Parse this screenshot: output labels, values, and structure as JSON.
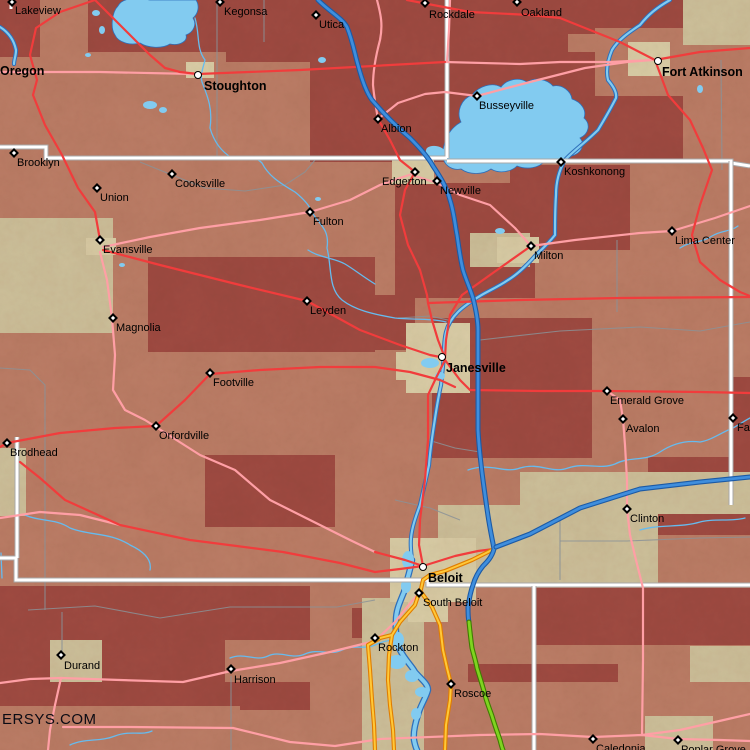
{
  "map": {
    "width": 750,
    "height": 750,
    "region": "southern-wisconsin-northern-illinois"
  },
  "watermark": {
    "text": "ERSYS.COM"
  },
  "colors": {
    "terrain_salmon": "#bd7e67",
    "terrain_maroon": "#a04b42",
    "terrain_tan": "#cfc29c",
    "terrain_urban": "#dbcfa8",
    "lake_fill": "#82cbf0",
    "water_casing": "#2e6fba",
    "creek": "#66bbee",
    "boundary_gray": "#8b9297",
    "road_white": "#ffffff",
    "road_white_casing": "#a8a8a8",
    "road_red": "#f13c3c",
    "road_pink": "#ff9fa5",
    "orange_core": "#ffc838",
    "orange_casing": "#e07d00",
    "interstate_core": "#3f8edd",
    "interstate_casing": "#1c5aa5",
    "toll_green_core": "#7fd420",
    "toll_green_casing": "#3f7d00",
    "label_color": "#000000"
  },
  "towns": [
    {
      "name": "Lakeview",
      "type": "town",
      "mx": 12,
      "my": 2,
      "lx": 15,
      "ly": 6
    },
    {
      "name": "Kegonsa",
      "type": "town",
      "mx": 220,
      "my": 2,
      "lx": 224,
      "ly": 7
    },
    {
      "name": "Utica",
      "type": "town",
      "mx": 316,
      "my": 15,
      "lx": 319,
      "ly": 20
    },
    {
      "name": "Rockdale",
      "type": "town",
      "mx": 425,
      "my": 3,
      "lx": 429,
      "ly": 10
    },
    {
      "name": "Oakland",
      "type": "town",
      "mx": 517,
      "my": 2,
      "lx": 521,
      "ly": 8
    },
    {
      "name": "Oregon",
      "type": "city",
      "mx": -6,
      "my": 72,
      "lx": 0,
      "ly": 65
    },
    {
      "name": "Stoughton",
      "type": "city",
      "mx": 198,
      "my": 75,
      "lx": 204,
      "ly": 80
    },
    {
      "name": "Fort Atkinson",
      "type": "city",
      "mx": 658,
      "my": 61,
      "lx": 662,
      "ly": 66
    },
    {
      "name": "Busseyville",
      "type": "town",
      "mx": 477,
      "my": 96,
      "lx": 479,
      "ly": 101
    },
    {
      "name": "Albion",
      "type": "town",
      "mx": 378,
      "my": 119,
      "lx": 381,
      "ly": 124
    },
    {
      "name": "Brooklyn",
      "type": "town",
      "mx": 14,
      "my": 153,
      "lx": 17,
      "ly": 158
    },
    {
      "name": "Cooksville",
      "type": "town",
      "mx": 172,
      "my": 174,
      "lx": 175,
      "ly": 179
    },
    {
      "name": "Union",
      "type": "town",
      "mx": 97,
      "my": 188,
      "lx": 100,
      "ly": 193
    },
    {
      "name": "Fulton",
      "type": "town",
      "mx": 310,
      "my": 212,
      "lx": 313,
      "ly": 217
    },
    {
      "name": "Edgerton",
      "type": "town",
      "mx": 415,
      "my": 172,
      "lx": 382,
      "ly": 177
    },
    {
      "name": "Newville",
      "type": "town",
      "mx": 437,
      "my": 181,
      "lx": 440,
      "ly": 186
    },
    {
      "name": "Koshkonong",
      "type": "town",
      "mx": 561,
      "my": 162,
      "lx": 564,
      "ly": 167
    },
    {
      "name": "Milton",
      "type": "town",
      "mx": 531,
      "my": 246,
      "lx": 534,
      "ly": 251
    },
    {
      "name": "Lima Center",
      "type": "town",
      "mx": 672,
      "my": 231,
      "lx": 675,
      "ly": 236
    },
    {
      "name": "Evansville",
      "type": "town",
      "mx": 100,
      "my": 240,
      "lx": 103,
      "ly": 245
    },
    {
      "name": "Magnolia",
      "type": "town",
      "mx": 113,
      "my": 318,
      "lx": 116,
      "ly": 323
    },
    {
      "name": "Leyden",
      "type": "town",
      "mx": 307,
      "my": 301,
      "lx": 310,
      "ly": 306
    },
    {
      "name": "Janesville",
      "type": "city",
      "mx": 442,
      "my": 357,
      "lx": 446,
      "ly": 362
    },
    {
      "name": "Footville",
      "type": "town",
      "mx": 210,
      "my": 373,
      "lx": 213,
      "ly": 378
    },
    {
      "name": "Emerald Grove",
      "type": "town",
      "mx": 607,
      "my": 391,
      "lx": 610,
      "ly": 396
    },
    {
      "name": "Avalon",
      "type": "town",
      "mx": 623,
      "my": 419,
      "lx": 626,
      "ly": 424
    },
    {
      "name": "Fairfield",
      "type": "town",
      "mx": 733,
      "my": 418,
      "lx": 737,
      "ly": 423
    },
    {
      "name": "Orfordville",
      "type": "town",
      "mx": 156,
      "my": 426,
      "lx": 159,
      "ly": 431
    },
    {
      "name": "Brodhead",
      "type": "town",
      "mx": 7,
      "my": 443,
      "lx": 10,
      "ly": 448
    },
    {
      "name": "Clinton",
      "type": "town",
      "mx": 627,
      "my": 509,
      "lx": 630,
      "ly": 514
    },
    {
      "name": "Beloit",
      "type": "city",
      "mx": 423,
      "my": 567,
      "lx": 428,
      "ly": 572
    },
    {
      "name": "South Beloit",
      "type": "town",
      "mx": 419,
      "my": 593,
      "lx": 423,
      "ly": 598
    },
    {
      "name": "Rockton",
      "type": "town",
      "mx": 375,
      "my": 638,
      "lx": 378,
      "ly": 643
    },
    {
      "name": "Durand",
      "type": "town",
      "mx": 61,
      "my": 655,
      "lx": 64,
      "ly": 661
    },
    {
      "name": "Harrison",
      "type": "town",
      "mx": 231,
      "my": 669,
      "lx": 234,
      "ly": 675
    },
    {
      "name": "Roscoe",
      "type": "town",
      "mx": 451,
      "my": 684,
      "lx": 454,
      "ly": 689
    },
    {
      "name": "Caledonia",
      "type": "town",
      "mx": 593,
      "my": 739,
      "lx": 596,
      "ly": 744
    },
    {
      "name": "Poplar Grove",
      "type": "town",
      "mx": 678,
      "my": 740,
      "lx": 681,
      "ly": 745
    }
  ],
  "features": {
    "lakes": [
      "Lake Kegonsa",
      "Lake Koshkonong"
    ],
    "rivers": [
      "Rock River",
      "Yahara Creek",
      "Turtle Creek"
    ],
    "highways": [
      "I-39/90 (blue)",
      "I-43 (blue)",
      "IL toll (green)"
    ]
  }
}
